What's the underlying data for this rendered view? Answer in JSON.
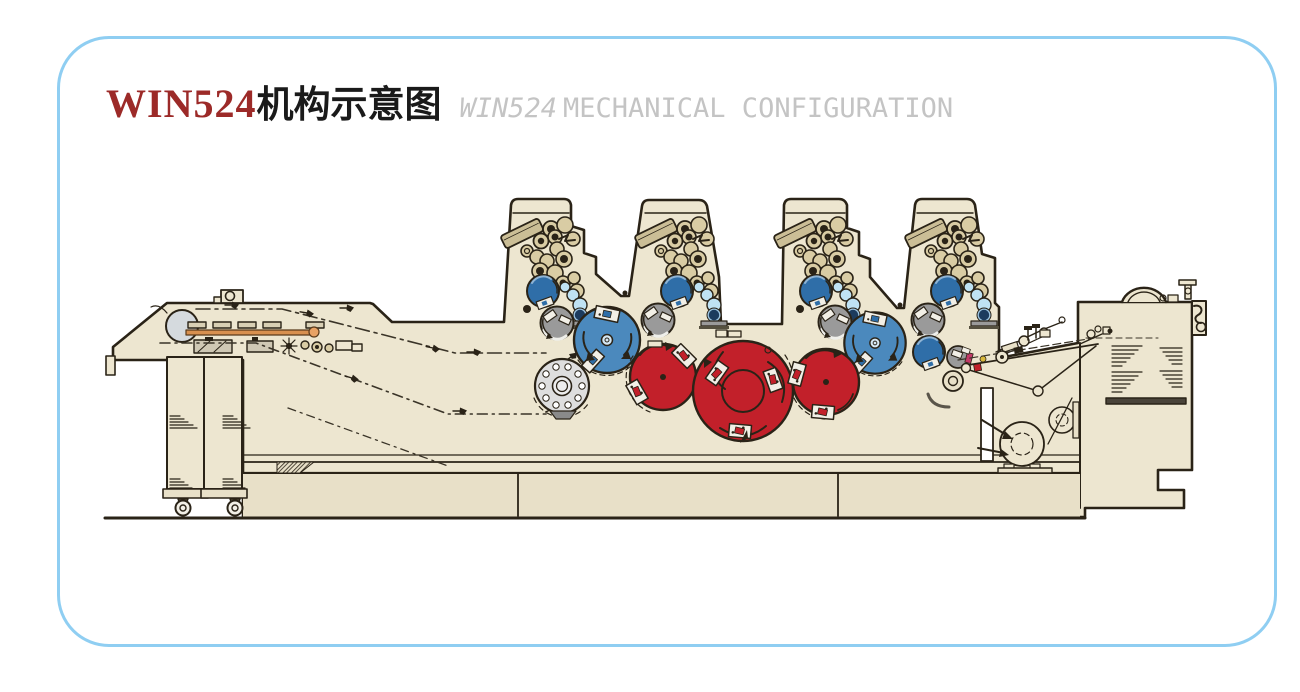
{
  "header": {
    "model": "WIN524",
    "title_cn": "机构示意图",
    "subtitle_model": "WIN524",
    "subtitle_text": "MECHANICAL CONFIGURATION"
  },
  "diagram": {
    "description": "Side elevation schematic of a WIN524 four-tower offset printing press: sheet feeder with pile carts at left, four inking towers with ink fountains and roller trains, blue blanket cylinders, red impression and transfer drums, and sheet delivery unit with pile at right."
  },
  "colors": {
    "frame": "#8FCEF2",
    "titleRed": "#9C2A28",
    "titleGray": "#C4C4C4",
    "ink": "#2A2317",
    "body": "#EDE6D0",
    "bodyDark": "#E8E0C8",
    "paper": "#F2EFE6",
    "blue": "#4B89BD",
    "blueDark": "#2F6EA8",
    "lightBlue": "#BFE2F4",
    "navy": "#1C3B5E",
    "red": "#C2202A",
    "magenta": "#C23A68",
    "yellow": "#D9B83C",
    "gray": "#9A9A9A",
    "lightGray": "#DEDEDE",
    "steel": "#D5DADE",
    "roller": "#D9CCA4",
    "fountain": "#CBBE96",
    "orange": "#D8904F"
  }
}
